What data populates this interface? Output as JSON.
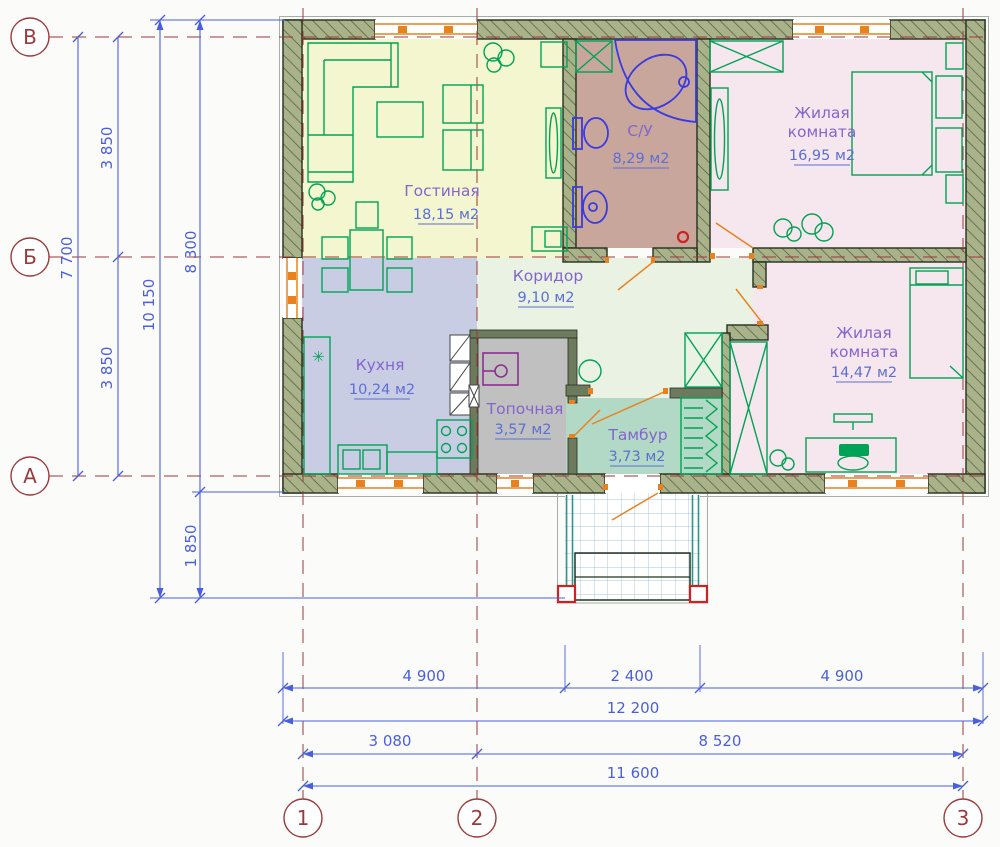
{
  "plan_title": "Floor plan of one-storey house",
  "rooms": [
    {
      "id": "living",
      "name": "Гостиная",
      "area": "18,15 м2",
      "color": "#f3f6cf"
    },
    {
      "id": "bathroom",
      "name": "С/У",
      "area": "8,29 м2",
      "color": "#c9a69c"
    },
    {
      "id": "bedroom1",
      "name_lines": [
        "Жилая",
        "комната"
      ],
      "area": "16,95 м2",
      "color": "#f6e6ee"
    },
    {
      "id": "kitchen",
      "name": "Кухня",
      "area": "10,24 м2",
      "color": "#c9cde4"
    },
    {
      "id": "corridor",
      "name": "Коридор",
      "area": "9,10 м2",
      "color": "#e9f2e3"
    },
    {
      "id": "boiler",
      "name": "Топочная",
      "area": "3,57 м2",
      "color": "#c0c0c0"
    },
    {
      "id": "vestibule",
      "name": "Тамбур",
      "area": "3,73 м2",
      "color": "#b2d8c6"
    },
    {
      "id": "bedroom2",
      "name_lines": [
        "Жилая",
        "комната"
      ],
      "area": "14,47 м2",
      "color": "#f6e6ee"
    }
  ],
  "axes": {
    "rows": [
      "В",
      "Б",
      "А"
    ],
    "cols": [
      "1",
      "2",
      "3"
    ]
  },
  "dimensions": {
    "left": [
      "7 700",
      "3 850",
      "3 850",
      "10 150",
      "8 300",
      "1 850"
    ],
    "bottom": [
      "4 900",
      "2 400",
      "4 900",
      "12 200",
      "3 080",
      "8 520",
      "11 600"
    ]
  },
  "colors": {
    "wall_fill": "#a9b289",
    "wall_edge": "#24301f",
    "furniture": "#00a355",
    "fixture": "#3a3ae0",
    "window": "#e8821e",
    "dim": "#4a5fe0",
    "axis": "#9a3a3a",
    "boiler": "#8b3090",
    "rail": "#2f9488",
    "accent_red": "#cc2222",
    "label": "#8565cc",
    "area": "#5b6fd5"
  }
}
